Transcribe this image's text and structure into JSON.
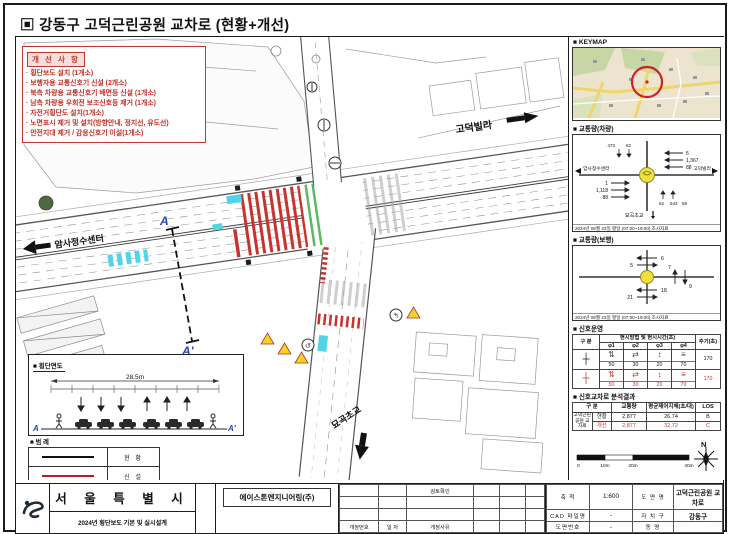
{
  "title": "▣ 강동구 고덕근린공원 교차로 (현황+개선)",
  "improvements": {
    "header": "개 선 사 항",
    "items": [
      "· 횡단보도 설치 (1개소)",
      "· 보행자용 교통신호기 신설 (2개소)",
      "· 북측 차량용 교통신호기 배면등 신설 (1개소)",
      "· 남측 차량용 우회전 보조신호등 제거 (1개소)",
      "· 자전거횡단도 설치(1개소)",
      "· 노면표시 제거 및 설치(방향안내, 정지선, 유도선)",
      "· 안전지대 제거 / 감응신호기 이설(1개소)"
    ]
  },
  "plan": {
    "east_label": "고덕빌라",
    "west_label": "암사정수센터",
    "south_label": "묘곡초교",
    "section_a": "A",
    "section_a2": "A'"
  },
  "cross_section": {
    "header": "■ 횡단면도",
    "total_width": "28.5m",
    "a": "A",
    "a2": "A'"
  },
  "legend": {
    "header": "■ 범 례",
    "items": [
      {
        "label": "현 황",
        "color": "#111111"
      },
      {
        "label": "신 설",
        "color": "#b22222"
      },
      {
        "label": "제 거",
        "color": "#49d3e6"
      },
      {
        "label": "이 설",
        "color": "#3fae4a"
      }
    ]
  },
  "sidebar": {
    "keymap": {
      "header": "■ KEYMAP"
    },
    "vehicle": {
      "header": "■ 교통량(차량)",
      "west": "암사정수센터",
      "east": "고덕빌라",
      "south": "묘곡초교",
      "wb": [
        "5",
        "1,367",
        "88"
      ],
      "eb": [
        "1",
        "1,118",
        "88"
      ],
      "nb": [
        "473",
        "62"
      ],
      "sb": [
        "62",
        "543",
        "59"
      ],
      "caption": "2024년 08월 23일 평일 (07:00~19:00) 조사자료"
    },
    "pedestrian": {
      "header": "■ 교통량(보행)",
      "top": [
        "6",
        "5"
      ],
      "right": [
        "7",
        "9"
      ],
      "bottom": [
        "18",
        "21"
      ],
      "caption": "2024년 08월 23일 평일 (07:00~19:00) 조사자료"
    },
    "signal": {
      "header": "■ 신호운영",
      "gubun": "구 분",
      "col_group": "현시방법 및 현시시간(초)",
      "phases": [
        "φ1",
        "φ2",
        "φ3",
        "φ4"
      ],
      "phase_icons": [
        "⇅",
        "⇄",
        "↕",
        "≡"
      ],
      "cycle_label": "주기(초)",
      "rows": [
        {
          "icon": "┼",
          "times": [
            "50",
            "30",
            "20",
            "70"
          ],
          "cycle": "170"
        },
        {
          "icon": "┼",
          "times": [
            "50",
            "30",
            "20",
            "70"
          ],
          "cycle": "170"
        }
      ]
    },
    "analysis": {
      "header": "■ 신호교차로 분석결과",
      "cols": [
        "구 분",
        "교통량",
        "평균제어지체(초/대)",
        "LOS"
      ],
      "stub": "고덕근린공원 교차로",
      "rows": [
        {
          "name": "현황",
          "vol": "2,877",
          "delay": "26.74",
          "los": "B"
        },
        {
          "name": "개선",
          "vol": "2,877",
          "delay": "32.72",
          "los": "C"
        }
      ]
    },
    "scalebar": {
      "ticks": [
        "0",
        "10m",
        "20m",
        "40m"
      ],
      "north": "N"
    }
  },
  "titleblock": {
    "agency": "서 울 특 별 시",
    "project": "2024년 횡단보도 기본 및 실시설계",
    "company": "에이스톤엔지니어링(주)",
    "review_label": "검토확인",
    "rev_no": "개정번호",
    "rev_date": "일 자",
    "rev_reason": "개정사유",
    "scale_label": "축 척",
    "scale_value": "1:600",
    "dwg_label": "도 면 명",
    "dwg_value": "고덕근린공원 교차로",
    "cad_label": "CAD 파일명",
    "cad_value": "-",
    "gu_label": "자 치 구",
    "gu_value": "강동구",
    "no_label": "도면번호",
    "no_value": "-",
    "dong_label": "동 명",
    "dong_value": ""
  }
}
